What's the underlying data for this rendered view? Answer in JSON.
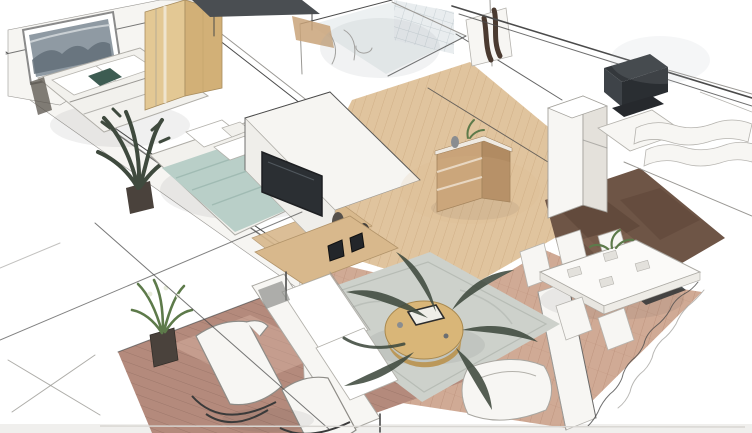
{
  "meta": {
    "alt": "Hand-sketched 3D isometric cutaway floor plan of a furnished apartment"
  },
  "palette": {
    "paper": "#ffffff",
    "bottom_strip": "#f0efed",
    "wall": "#f6f5f2",
    "soft_white": "#f7f6f3",
    "ink": "#4b4b4b",
    "ink_light": "#9a9894",
    "wood_wardrobe": "#e3c894",
    "wood_wardrobe_dark": "#d2b077",
    "oak_floor": "#ddbe94",
    "oak_line": "#c39f72",
    "wood_console": "#d8b88c",
    "wood_sideboard": "#c9a379",
    "wood_sideboard_dark": "#b18b62",
    "wood_table": "#d9b678",
    "wood_table_dark": "#bb985a",
    "duvet_teal": "#b9cfc8",
    "duvet_fold": "#9db8b0",
    "pillow_white": "#f2f1ed",
    "artwork_gray": "#8f9aa3",
    "artwork_dark": "#5f6c76",
    "accent_cushion": "#3d5c52",
    "brick_floor": "#c89b82",
    "brick_line": "#a97a63",
    "dark_floor": "#6e5546",
    "dark_floor_deep": "#5a4336",
    "rug_gray": "#cdd1cb",
    "rug_line": "#b7bcb5",
    "deck_red": "#b48a7c",
    "deck_line": "#8e6a5e",
    "deck_light": "#d9b3a3",
    "plant_dark": "#3f4a3e",
    "plant_green": "#5d7a4a",
    "charcoal": "#34383c",
    "tv_black": "#2b2f33",
    "desk_gray": "#4a4e52",
    "glass_tile": "#e9edef",
    "glass_grid": "#c7d0d4",
    "sculpt_brown": "#4a3a30"
  },
  "scene": {
    "view": "isometric cutaway from above",
    "style": "pencil sketch with watercolor rendering",
    "rooms": [
      {
        "name": "secondary-bedroom",
        "items": [
          "framed-wall-art",
          "double-bed-white",
          "accent-cushion",
          "wardrobe",
          "desk"
        ]
      },
      {
        "name": "master-bedroom",
        "items": [
          "double-bed-teal",
          "pillows",
          "potted-palm",
          "tv-partition",
          "wall-tv",
          "media-console",
          "vases",
          "foot-bench"
        ]
      },
      {
        "name": "bathroom",
        "items": [
          "glass-block-wall",
          "sink-fixtures",
          "shower-sketch"
        ]
      },
      {
        "name": "utility-room",
        "items": [
          "wall-sculpture",
          "white-appliance"
        ]
      },
      {
        "name": "hallway",
        "items": [
          "oak-floor",
          "wooden-sideboard",
          "table-decor"
        ]
      },
      {
        "name": "kitchen",
        "items": [
          "dark-wood-floor",
          "tall-white-cabinet",
          "dark-lounge-chair",
          "white-counter"
        ]
      },
      {
        "name": "living-room",
        "items": [
          "area-rug",
          "white-sofa",
          "white-armchair",
          "round-coffee-table",
          "tablet-on-table",
          "large-dark-plant",
          "gallery-frames"
        ]
      },
      {
        "name": "dining-area",
        "items": [
          "white-dining-table",
          "dining-chairs",
          "centerpiece-plant",
          "window-bench",
          "railing-sketch"
        ]
      },
      {
        "name": "balcony",
        "items": [
          "plank-deck",
          "lounge-chair-left",
          "lounge-chair-right",
          "potted-plant",
          "construction-lines"
        ]
      }
    ]
  }
}
